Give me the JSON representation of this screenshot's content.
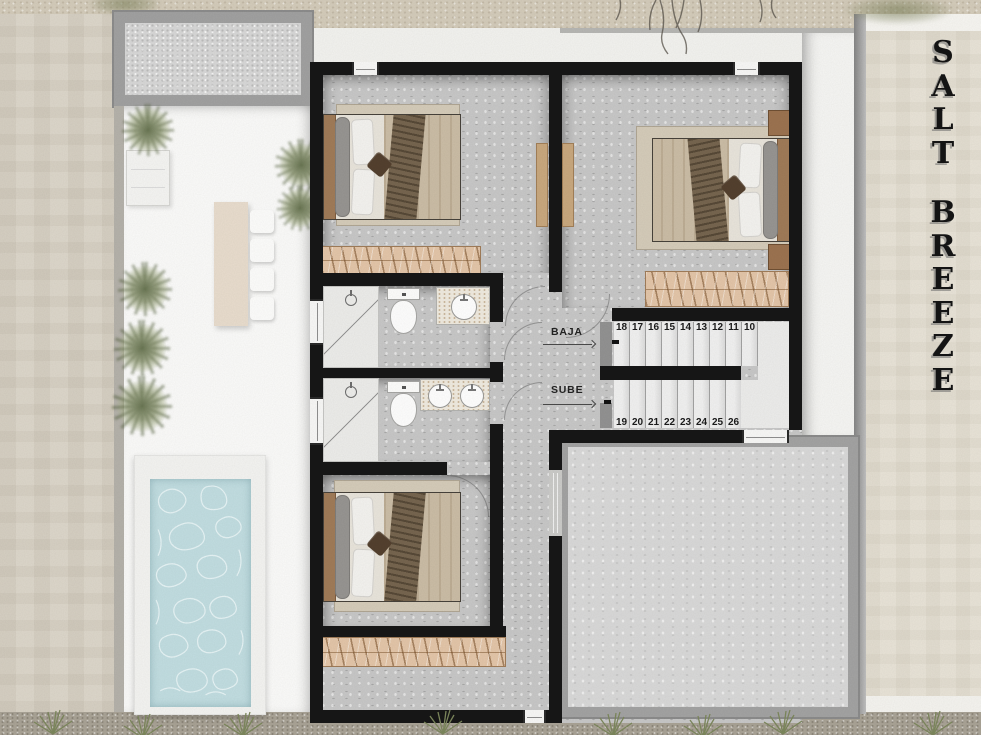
{
  "project": {
    "title": "SALT BREEZE",
    "title_words": [
      "SALT",
      "BREEZE"
    ]
  },
  "stairs": {
    "down_label": "BAJA",
    "up_label": "SUBE",
    "upper_run_steps": [
      "18",
      "17",
      "16",
      "15",
      "14",
      "13",
      "12",
      "11",
      "10"
    ],
    "lower_run_steps": [
      "19",
      "20",
      "21",
      "22",
      "23",
      "24",
      "25",
      "26",
      "27"
    ]
  },
  "palette": {
    "wall_black": "#161616",
    "sand": "#d6cfc0",
    "exterior_wall": "#ddd7cb",
    "terrace_white": "#fbfbfa",
    "concrete_floor": "#c8c8c8",
    "terrace_room_floor": "#d9d9d9",
    "pool_water": "#c2dee2",
    "closet_wood": "#e4c6a9",
    "bed_wood": "#a07b58",
    "plant_green": "#8c976f",
    "frame_gray": "#a3a3a3"
  }
}
